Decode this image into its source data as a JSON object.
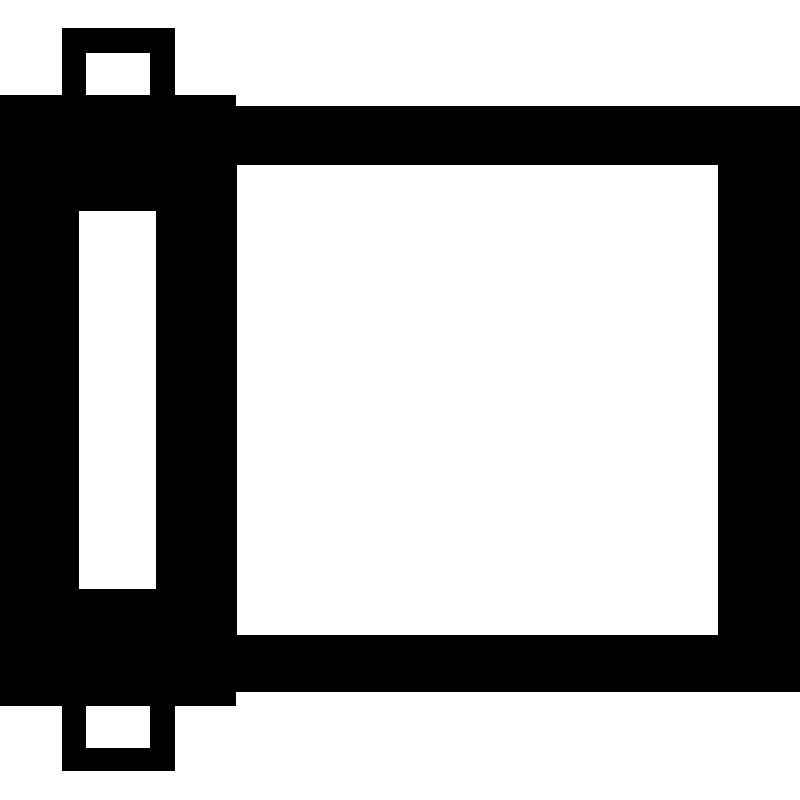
{
  "icon": {
    "name": "film-roll-icon",
    "colors": {
      "foreground": "#000000",
      "background": "#ffffff"
    }
  }
}
